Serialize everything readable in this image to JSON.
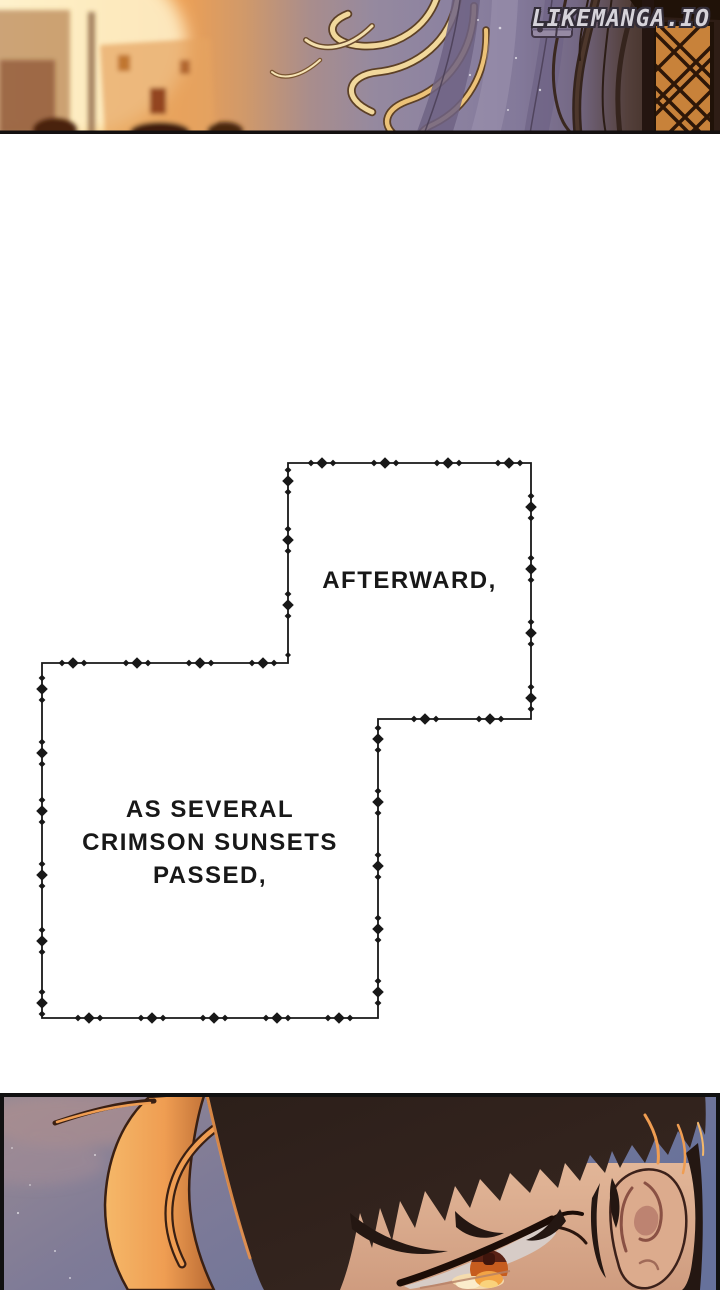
{
  "watermark": {
    "text": "LIKEMANGA.IO"
  },
  "narration": {
    "box1": {
      "text": "AFTERWARD,"
    },
    "box2": {
      "lines": [
        "AS SEVERAL",
        "CRIMSON SUNSETS",
        "PASSED,"
      ]
    }
  },
  "palette": {
    "page-bg": "#ffffff",
    "ink": "#181818",
    "watermark-color": "#d6d3da",
    "sunset-glow": "#fbd98e",
    "sunset-orange": "#eda055",
    "fabric-purple": "#8d83a0",
    "window-lattice": "#c8823a",
    "dusk-sky": "#6a7099",
    "cloud-pink": "#b2959a",
    "hair-dark": "#2c1f1a",
    "rim-light": "#ef9d52",
    "iris-orange": "#c65c1e",
    "skin": "#dcae92"
  }
}
